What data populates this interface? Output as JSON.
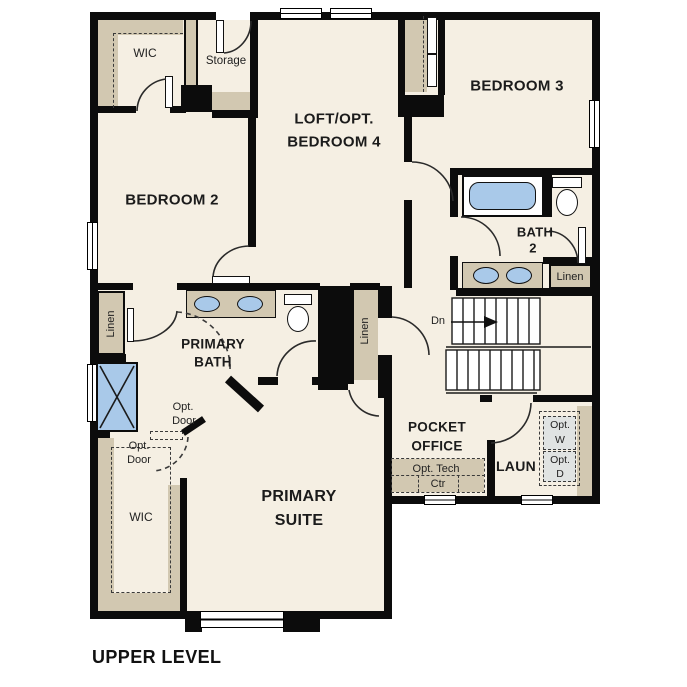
{
  "title": "UPPER LEVEL",
  "colors": {
    "wall": "#0c0c0c",
    "floor": "#f5efe3",
    "cabinet_tan": "#d2c8b1",
    "fixture_blue": "#a9c9e9",
    "appliance_gray": "#e0e3e2"
  },
  "labels": {
    "upper_wic": "WIC",
    "storage": "Storage",
    "loft1": "LOFT/OPT.",
    "loft2": "BEDROOM 4",
    "bedroom3": "BEDROOM 3",
    "bedroom2": "BEDROOM 2",
    "bath2_1": "BATH",
    "bath2_2": "2",
    "linen_bath2": "Linen",
    "linen_hall": "Linen",
    "linen_center": "Linen",
    "primary_bath1": "PRIMARY",
    "primary_bath2": "BATH",
    "stairs_dn": "Dn",
    "pocket1": "POCKET",
    "pocket2": "OFFICE",
    "tech1": "Opt. Tech",
    "tech2": "Ctr",
    "laundry": "LAUN",
    "optw1": "Opt.",
    "optw2": "W",
    "optd1": "Opt.",
    "optd2": "D",
    "optdoor1a": "Opt.",
    "optdoor1b": "Door",
    "optdoor2a": "Opt.",
    "optdoor2b": "Door",
    "lower_wic": "WIC",
    "suite1": "PRIMARY",
    "suite2": "SUITE"
  }
}
